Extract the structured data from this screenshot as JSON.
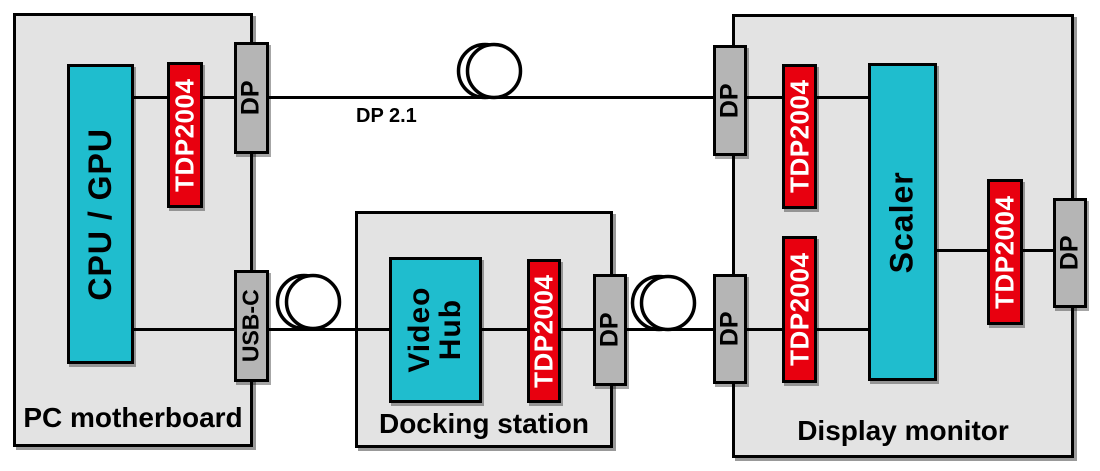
{
  "colors": {
    "block_fill": "#e3e3e3",
    "port_fill": "#b5b5b5",
    "chip_cyan": "#1fbdce",
    "redriver_red": "#e8000f",
    "line_black": "#000000",
    "canvas_bg": "#ffffff"
  },
  "pc": {
    "label": "PC motherboard",
    "chip": "CPU / GPU",
    "redriver": "TDP2004",
    "port_dp": "DP",
    "port_usbc": "USB-C"
  },
  "cable": {
    "top_label": "DP 2.1"
  },
  "dock": {
    "label": "Docking station",
    "chip_lines": [
      "Video",
      "Hub"
    ],
    "redriver": "TDP2004",
    "port_dp": "DP"
  },
  "monitor": {
    "label": "Display monitor",
    "chip": "Scaler",
    "redriver_in_top": "TDP2004",
    "redriver_in_bottom": "TDP2004",
    "redriver_out": "TDP2004",
    "port_dp_in_top": "DP",
    "port_dp_in_bottom": "DP",
    "port_dp_out": "DP"
  }
}
